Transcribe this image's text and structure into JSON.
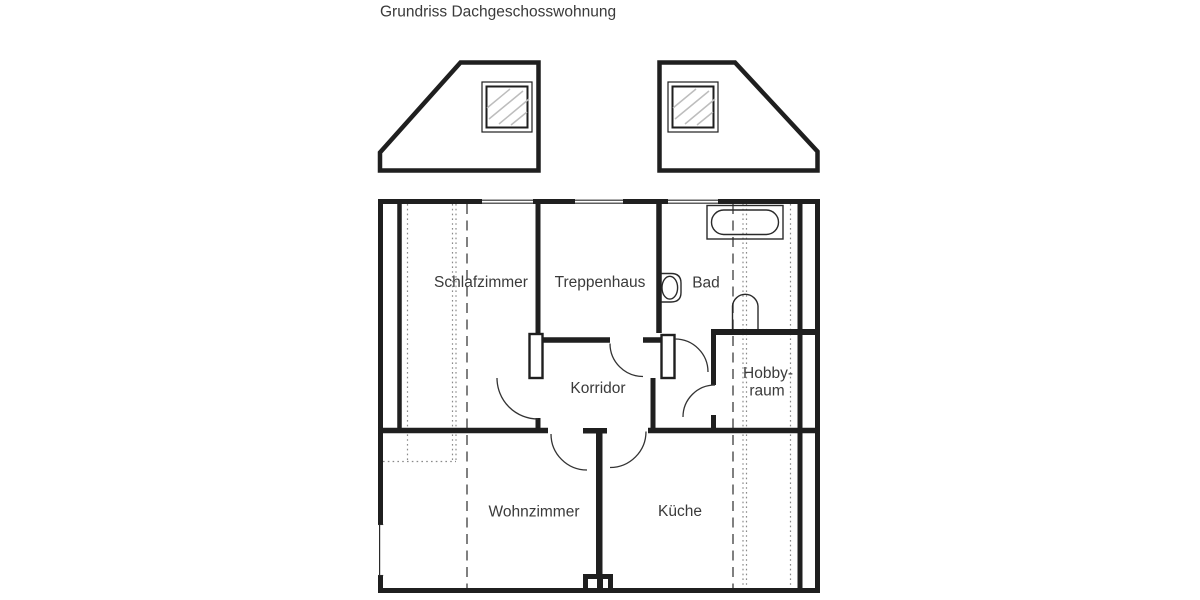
{
  "title": "Grundriss Dachgeschosswohnung",
  "rooms": {
    "schlafzimmer": {
      "label": "Schlafzimmer"
    },
    "treppenhaus": {
      "label": "Treppenhaus"
    },
    "bad": {
      "label": "Bad"
    },
    "hobbyraum": {
      "line1": "Hobby-",
      "line2": "raum"
    },
    "korridor": {
      "label": "Korridor"
    },
    "wohnzimmer": {
      "label": "Wohnzimmer"
    },
    "kueche": {
      "label": "Küche"
    }
  },
  "fixtures": {
    "bathtub": "bathtub",
    "washbasin": "washbasin",
    "toilet": "toilet",
    "chimney": "chimney"
  },
  "dormers": {
    "left": "dormer-with-window",
    "right": "dormer-with-window"
  },
  "colors": {
    "background": "#ffffff",
    "wall": "#1f1f1f",
    "text": "#3a3a3a",
    "door_arc": "#333333",
    "fixture": "#2a2a2a",
    "dotted_roof_line": "#8a8a8a",
    "dashed_roof_line": "#4a4a4a",
    "window_glass_hatch": "#bdbdbd"
  }
}
